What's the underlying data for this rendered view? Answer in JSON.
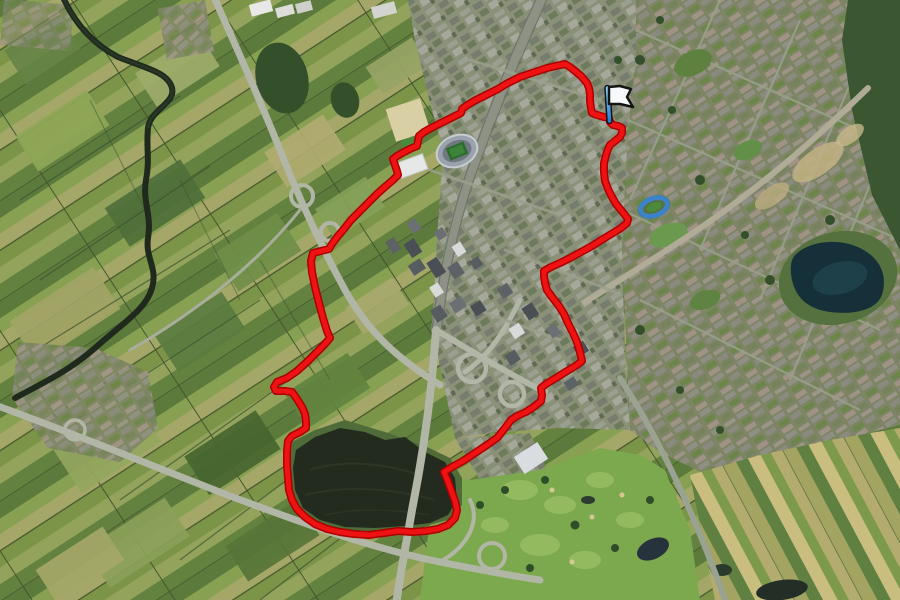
{
  "map": {
    "type": "satellite-aerial",
    "scene": "aerial view of Dutch city with stadium, motorways, farmland, lakes; red route loop overlay with flag marker",
    "width_px": 900,
    "height_px": 600
  },
  "route": {
    "color": "#ee1212",
    "casing_color": "#ad0000",
    "stroke_width": 5,
    "casing_width": 8,
    "closed": true,
    "points": [
      [
        565,
        64
      ],
      [
        556,
        66
      ],
      [
        547,
        68
      ],
      [
        538,
        71
      ],
      [
        529,
        74
      ],
      [
        520,
        77
      ],
      [
        514,
        80
      ],
      [
        506,
        84
      ],
      [
        498,
        89
      ],
      [
        490,
        93
      ],
      [
        482,
        97
      ],
      [
        474,
        101
      ],
      [
        466,
        106
      ],
      [
        462,
        109
      ],
      [
        461,
        113
      ],
      [
        455,
        116
      ],
      [
        447,
        120
      ],
      [
        439,
        124
      ],
      [
        431,
        128
      ],
      [
        424,
        132
      ],
      [
        419,
        136
      ],
      [
        418,
        141
      ],
      [
        417,
        146
      ],
      [
        412,
        148
      ],
      [
        404,
        152
      ],
      [
        397,
        156
      ],
      [
        393,
        159
      ],
      [
        395,
        165
      ],
      [
        397,
        171
      ],
      [
        398,
        175
      ],
      [
        393,
        180
      ],
      [
        386,
        186
      ],
      [
        378,
        193
      ],
      [
        369,
        202
      ],
      [
        360,
        211
      ],
      [
        351,
        220
      ],
      [
        344,
        229
      ],
      [
        338,
        236
      ],
      [
        332,
        244
      ],
      [
        329,
        249
      ],
      [
        321,
        251
      ],
      [
        313,
        253
      ],
      [
        311,
        261
      ],
      [
        312,
        272
      ],
      [
        315,
        287
      ],
      [
        319,
        303
      ],
      [
        323,
        318
      ],
      [
        327,
        331
      ],
      [
        330,
        338
      ],
      [
        324,
        345
      ],
      [
        317,
        352
      ],
      [
        308,
        361
      ],
      [
        297,
        371
      ],
      [
        287,
        378
      ],
      [
        277,
        382
      ],
      [
        274,
        387
      ],
      [
        276,
        391
      ],
      [
        285,
        391
      ],
      [
        292,
        392
      ],
      [
        297,
        399
      ],
      [
        302,
        407
      ],
      [
        305,
        414
      ],
      [
        306,
        421
      ],
      [
        306,
        428
      ],
      [
        300,
        432
      ],
      [
        292,
        436
      ],
      [
        288,
        441
      ],
      [
        287,
        452
      ],
      [
        287,
        465
      ],
      [
        288,
        478
      ],
      [
        289,
        490
      ],
      [
        292,
        500
      ],
      [
        297,
        509
      ],
      [
        305,
        517
      ],
      [
        315,
        524
      ],
      [
        327,
        529
      ],
      [
        340,
        532
      ],
      [
        354,
        534
      ],
      [
        369,
        535
      ],
      [
        384,
        533
      ],
      [
        398,
        531
      ],
      [
        412,
        532
      ],
      [
        426,
        531
      ],
      [
        438,
        529
      ],
      [
        448,
        525
      ],
      [
        455,
        518
      ],
      [
        457,
        510
      ],
      [
        455,
        501
      ],
      [
        451,
        490
      ],
      [
        447,
        479
      ],
      [
        444,
        472
      ],
      [
        452,
        467
      ],
      [
        463,
        461
      ],
      [
        475,
        453
      ],
      [
        487,
        445
      ],
      [
        497,
        438
      ],
      [
        505,
        428
      ],
      [
        511,
        420
      ],
      [
        517,
        416
      ],
      [
        526,
        412
      ],
      [
        535,
        406
      ],
      [
        541,
        401
      ],
      [
        542,
        395
      ],
      [
        541,
        388
      ],
      [
        546,
        384
      ],
      [
        556,
        378
      ],
      [
        567,
        371
      ],
      [
        577,
        365
      ],
      [
        582,
        361
      ],
      [
        580,
        352
      ],
      [
        577,
        342
      ],
      [
        573,
        333
      ],
      [
        570,
        327
      ],
      [
        567,
        321
      ],
      [
        564,
        314
      ],
      [
        559,
        306
      ],
      [
        552,
        297
      ],
      [
        547,
        290
      ],
      [
        545,
        283
      ],
      [
        544,
        276
      ],
      [
        544,
        271
      ],
      [
        551,
        267
      ],
      [
        560,
        263
      ],
      [
        570,
        258
      ],
      [
        581,
        252
      ],
      [
        592,
        246
      ],
      [
        603,
        239
      ],
      [
        613,
        233
      ],
      [
        621,
        228
      ],
      [
        627,
        223
      ],
      [
        628,
        219
      ],
      [
        625,
        215
      ],
      [
        621,
        210
      ],
      [
        616,
        204
      ],
      [
        612,
        197
      ],
      [
        608,
        189
      ],
      [
        605,
        181
      ],
      [
        604,
        172
      ],
      [
        604,
        163
      ],
      [
        606,
        155
      ],
      [
        608,
        149
      ],
      [
        610,
        145
      ],
      [
        615,
        141
      ],
      [
        620,
        137
      ],
      [
        622,
        133
      ],
      [
        622,
        128
      ],
      [
        618,
        126
      ],
      [
        613,
        125
      ],
      [
        610,
        122
      ],
      [
        609,
        118
      ],
      [
        604,
        117
      ],
      [
        597,
        115
      ],
      [
        592,
        113
      ],
      [
        591,
        108
      ],
      [
        590,
        101
      ],
      [
        590,
        94
      ],
      [
        589,
        88
      ],
      [
        587,
        83
      ],
      [
        581,
        76
      ],
      [
        575,
        71
      ],
      [
        570,
        67
      ]
    ]
  },
  "flag": {
    "pole_top": [
      607.5,
      88
    ],
    "pole_base": [
      609.5,
      121
    ],
    "pole_width": 3.5,
    "pole_color_top": "#8ecdf2",
    "pole_color_bottom": "#2e7cd0",
    "outline_color": "#141414",
    "banner_fill": "#f6fafd",
    "banner_points": [
      [
        609,
        87
      ],
      [
        620,
        86
      ],
      [
        631,
        89
      ],
      [
        627,
        97
      ],
      [
        633,
        107
      ],
      [
        620,
        104
      ],
      [
        609,
        104
      ]
    ]
  },
  "palette": {
    "field_greens": [
      "#50703a",
      "#708f48",
      "#8fa757",
      "#a2a465",
      "#b0ab70"
    ],
    "forest": "#33502b",
    "water_dark": "#1f2a1d",
    "lake_right": "#16303a",
    "lake_bottom": "#232b1f",
    "highway": "#b2b6a6",
    "urban_base": "#8b9078",
    "suburb_base": "#7e8565",
    "golf": "#7ca94e",
    "track_blue": "#3b82c8",
    "stadium_roof": "#9aa2ab",
    "pitch_green": "#2c6b2c"
  }
}
